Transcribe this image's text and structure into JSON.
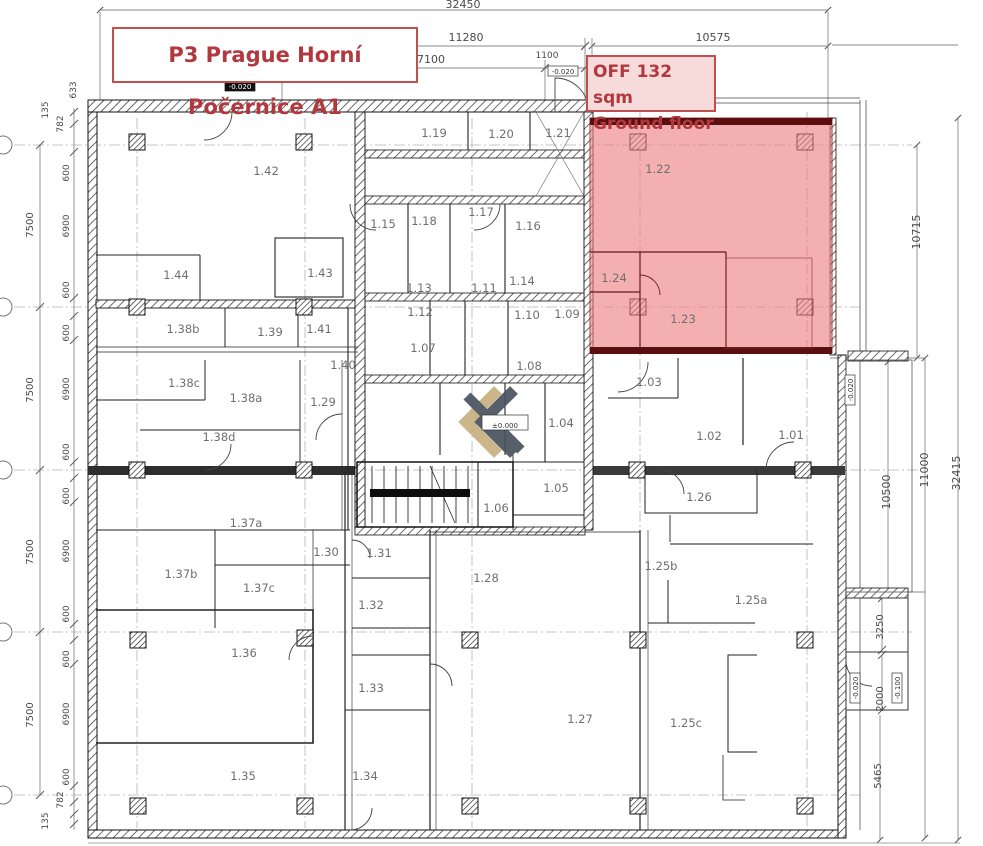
{
  "title_box": {
    "text": "P3 Prague Horní Počernice A1"
  },
  "off_box": {
    "line1": "OFF 132 sqm",
    "line2": "Ground floor"
  },
  "colors": {
    "annotation_text": "#b2383f",
    "annotation_border": "#c0504d",
    "highlight_fill": "#ee8181",
    "highlight_border": "#a02525",
    "logo_gold": "#c8af80",
    "logo_gray": "#49525e"
  },
  "rooms": [
    {
      "label": "1.01",
      "x": 791,
      "y": 439
    },
    {
      "label": "1.02",
      "x": 709,
      "y": 440
    },
    {
      "label": "1.03",
      "x": 649,
      "y": 386
    },
    {
      "label": "1.04",
      "x": 561,
      "y": 427
    },
    {
      "label": "1.05",
      "x": 556,
      "y": 492
    },
    {
      "label": "1.06",
      "x": 496,
      "y": 512
    },
    {
      "label": "1.07",
      "x": 423,
      "y": 352
    },
    {
      "label": "1.08",
      "x": 529,
      "y": 370
    },
    {
      "label": "1.09",
      "x": 567,
      "y": 318
    },
    {
      "label": "1.10",
      "x": 527,
      "y": 319
    },
    {
      "label": "1.11",
      "x": 484,
      "y": 292
    },
    {
      "label": "1.12",
      "x": 420,
      "y": 316
    },
    {
      "label": "1.13",
      "x": 419,
      "y": 292
    },
    {
      "label": "1.14",
      "x": 522,
      "y": 285
    },
    {
      "label": "1.15",
      "x": 383,
      "y": 228
    },
    {
      "label": "1.16",
      "x": 528,
      "y": 230
    },
    {
      "label": "1.17",
      "x": 481,
      "y": 216
    },
    {
      "label": "1.18",
      "x": 424,
      "y": 225
    },
    {
      "label": "1.19",
      "x": 434,
      "y": 137
    },
    {
      "label": "1.20",
      "x": 501,
      "y": 138
    },
    {
      "label": "1.21",
      "x": 558,
      "y": 137
    },
    {
      "label": "1.22",
      "x": 658,
      "y": 173
    },
    {
      "label": "1.23",
      "x": 683,
      "y": 323
    },
    {
      "label": "1.24",
      "x": 614,
      "y": 282
    },
    {
      "label": "1.25a",
      "x": 751,
      "y": 604
    },
    {
      "label": "1.25b",
      "x": 661,
      "y": 570
    },
    {
      "label": "1.25c",
      "x": 686,
      "y": 727
    },
    {
      "label": "1.26",
      "x": 699,
      "y": 501
    },
    {
      "label": "1.27",
      "x": 580,
      "y": 723
    },
    {
      "label": "1.28",
      "x": 486,
      "y": 582
    },
    {
      "label": "1.29",
      "x": 323,
      "y": 406
    },
    {
      "label": "1.30",
      "x": 326,
      "y": 556
    },
    {
      "label": "1.31",
      "x": 379,
      "y": 557
    },
    {
      "label": "1.32",
      "x": 371,
      "y": 609
    },
    {
      "label": "1.33",
      "x": 371,
      "y": 692
    },
    {
      "label": "1.34",
      "x": 365,
      "y": 780
    },
    {
      "label": "1.35",
      "x": 243,
      "y": 780
    },
    {
      "label": "1.36",
      "x": 244,
      "y": 657
    },
    {
      "label": "1.37a",
      "x": 246,
      "y": 527
    },
    {
      "label": "1.37b",
      "x": 181,
      "y": 578
    },
    {
      "label": "1.37c",
      "x": 259,
      "y": 592
    },
    {
      "label": "1.38a",
      "x": 246,
      "y": 402
    },
    {
      "label": "1.38b",
      "x": 183,
      "y": 333
    },
    {
      "label": "1.38c",
      "x": 184,
      "y": 387
    },
    {
      "label": "1.38d",
      "x": 219,
      "y": 441
    },
    {
      "label": "1.39",
      "x": 270,
      "y": 336
    },
    {
      "label": "1.40",
      "x": 343,
      "y": 369
    },
    {
      "label": "1.41",
      "x": 319,
      "y": 333
    },
    {
      "label": "1.42",
      "x": 266,
      "y": 175
    },
    {
      "label": "1.43",
      "x": 320,
      "y": 277
    },
    {
      "label": "1.44",
      "x": 176,
      "y": 279
    }
  ],
  "dim_labels": [
    {
      "text": "32450",
      "x": 463,
      "y": 8,
      "size": 11
    },
    {
      "text": "11280",
      "x": 466,
      "y": 41,
      "size": 11
    },
    {
      "text": "7100",
      "x": 431,
      "y": 63,
      "size": 11
    },
    {
      "text": "1100",
      "x": 547,
      "y": 58,
      "size": 9
    },
    {
      "text": "10575",
      "x": 713,
      "y": 41,
      "size": 11
    },
    {
      "text": "633",
      "x": 76,
      "y": 90,
      "rot": -90,
      "size": 9
    },
    {
      "text": "135",
      "x": 48,
      "y": 110,
      "rot": -90,
      "size": 9
    },
    {
      "text": "782",
      "x": 63,
      "y": 124,
      "rot": -90,
      "size": 9
    },
    {
      "text": "7500",
      "x": 33,
      "y": 225,
      "rot": -90,
      "size": 10
    },
    {
      "text": "7500",
      "x": 33,
      "y": 390,
      "rot": -90,
      "size": 10
    },
    {
      "text": "7500",
      "x": 33,
      "y": 552,
      "rot": -90,
      "size": 10
    },
    {
      "text": "7500",
      "x": 33,
      "y": 715,
      "rot": -90,
      "size": 10
    },
    {
      "text": "600",
      "x": 69,
      "y": 173,
      "rot": -90,
      "size": 9
    },
    {
      "text": "6900",
      "x": 69,
      "y": 226,
      "rot": -90,
      "size": 9
    },
    {
      "text": "600",
      "x": 69,
      "y": 290,
      "rot": -90,
      "size": 9
    },
    {
      "text": "600",
      "x": 69,
      "y": 333,
      "rot": -90,
      "size": 9
    },
    {
      "text": "6900",
      "x": 69,
      "y": 389,
      "rot": -90,
      "size": 9
    },
    {
      "text": "600",
      "x": 69,
      "y": 452,
      "rot": -90,
      "size": 9
    },
    {
      "text": "600",
      "x": 69,
      "y": 496,
      "rot": -90,
      "size": 9
    },
    {
      "text": "6900",
      "x": 69,
      "y": 551,
      "rot": -90,
      "size": 9
    },
    {
      "text": "600",
      "x": 69,
      "y": 614,
      "rot": -90,
      "size": 9
    },
    {
      "text": "600",
      "x": 69,
      "y": 659,
      "rot": -90,
      "size": 9
    },
    {
      "text": "6900",
      "x": 69,
      "y": 714,
      "rot": -90,
      "size": 9
    },
    {
      "text": "600",
      "x": 69,
      "y": 777,
      "rot": -90,
      "size": 9
    },
    {
      "text": "782",
      "x": 63,
      "y": 800,
      "rot": -90,
      "size": 9
    },
    {
      "text": "135",
      "x": 48,
      "y": 821,
      "rot": -90,
      "size": 9
    },
    {
      "text": "10715",
      "x": 920,
      "y": 232,
      "rot": -90,
      "size": 11
    },
    {
      "text": "11000",
      "x": 928,
      "y": 470,
      "rot": -90,
      "size": 11
    },
    {
      "text": "32415",
      "x": 960,
      "y": 473,
      "rot": -90,
      "size": 11
    },
    {
      "text": "10500",
      "x": 890,
      "y": 492,
      "rot": -90,
      "size": 11
    },
    {
      "text": "3250",
      "x": 883,
      "y": 627,
      "rot": -90,
      "size": 10
    },
    {
      "text": "2000",
      "x": 883,
      "y": 699,
      "rot": -90,
      "size": 10
    },
    {
      "text": "5465",
      "x": 881,
      "y": 776,
      "rot": -90,
      "size": 10
    }
  ],
  "level_labels": [
    {
      "text": "-0.020",
      "x": 240,
      "y": 89,
      "dark": true
    },
    {
      "text": "-0.020",
      "x": 563,
      "y": 74
    },
    {
      "text": "±0.000",
      "x": 505,
      "y": 428,
      "big": true
    },
    {
      "text": "-0.020",
      "x": 853,
      "y": 390,
      "rot": -90
    },
    {
      "text": "-0.020",
      "x": 858,
      "y": 688,
      "rot": -90
    },
    {
      "text": "-0.100",
      "x": 900,
      "y": 688,
      "rot": -90
    }
  ]
}
